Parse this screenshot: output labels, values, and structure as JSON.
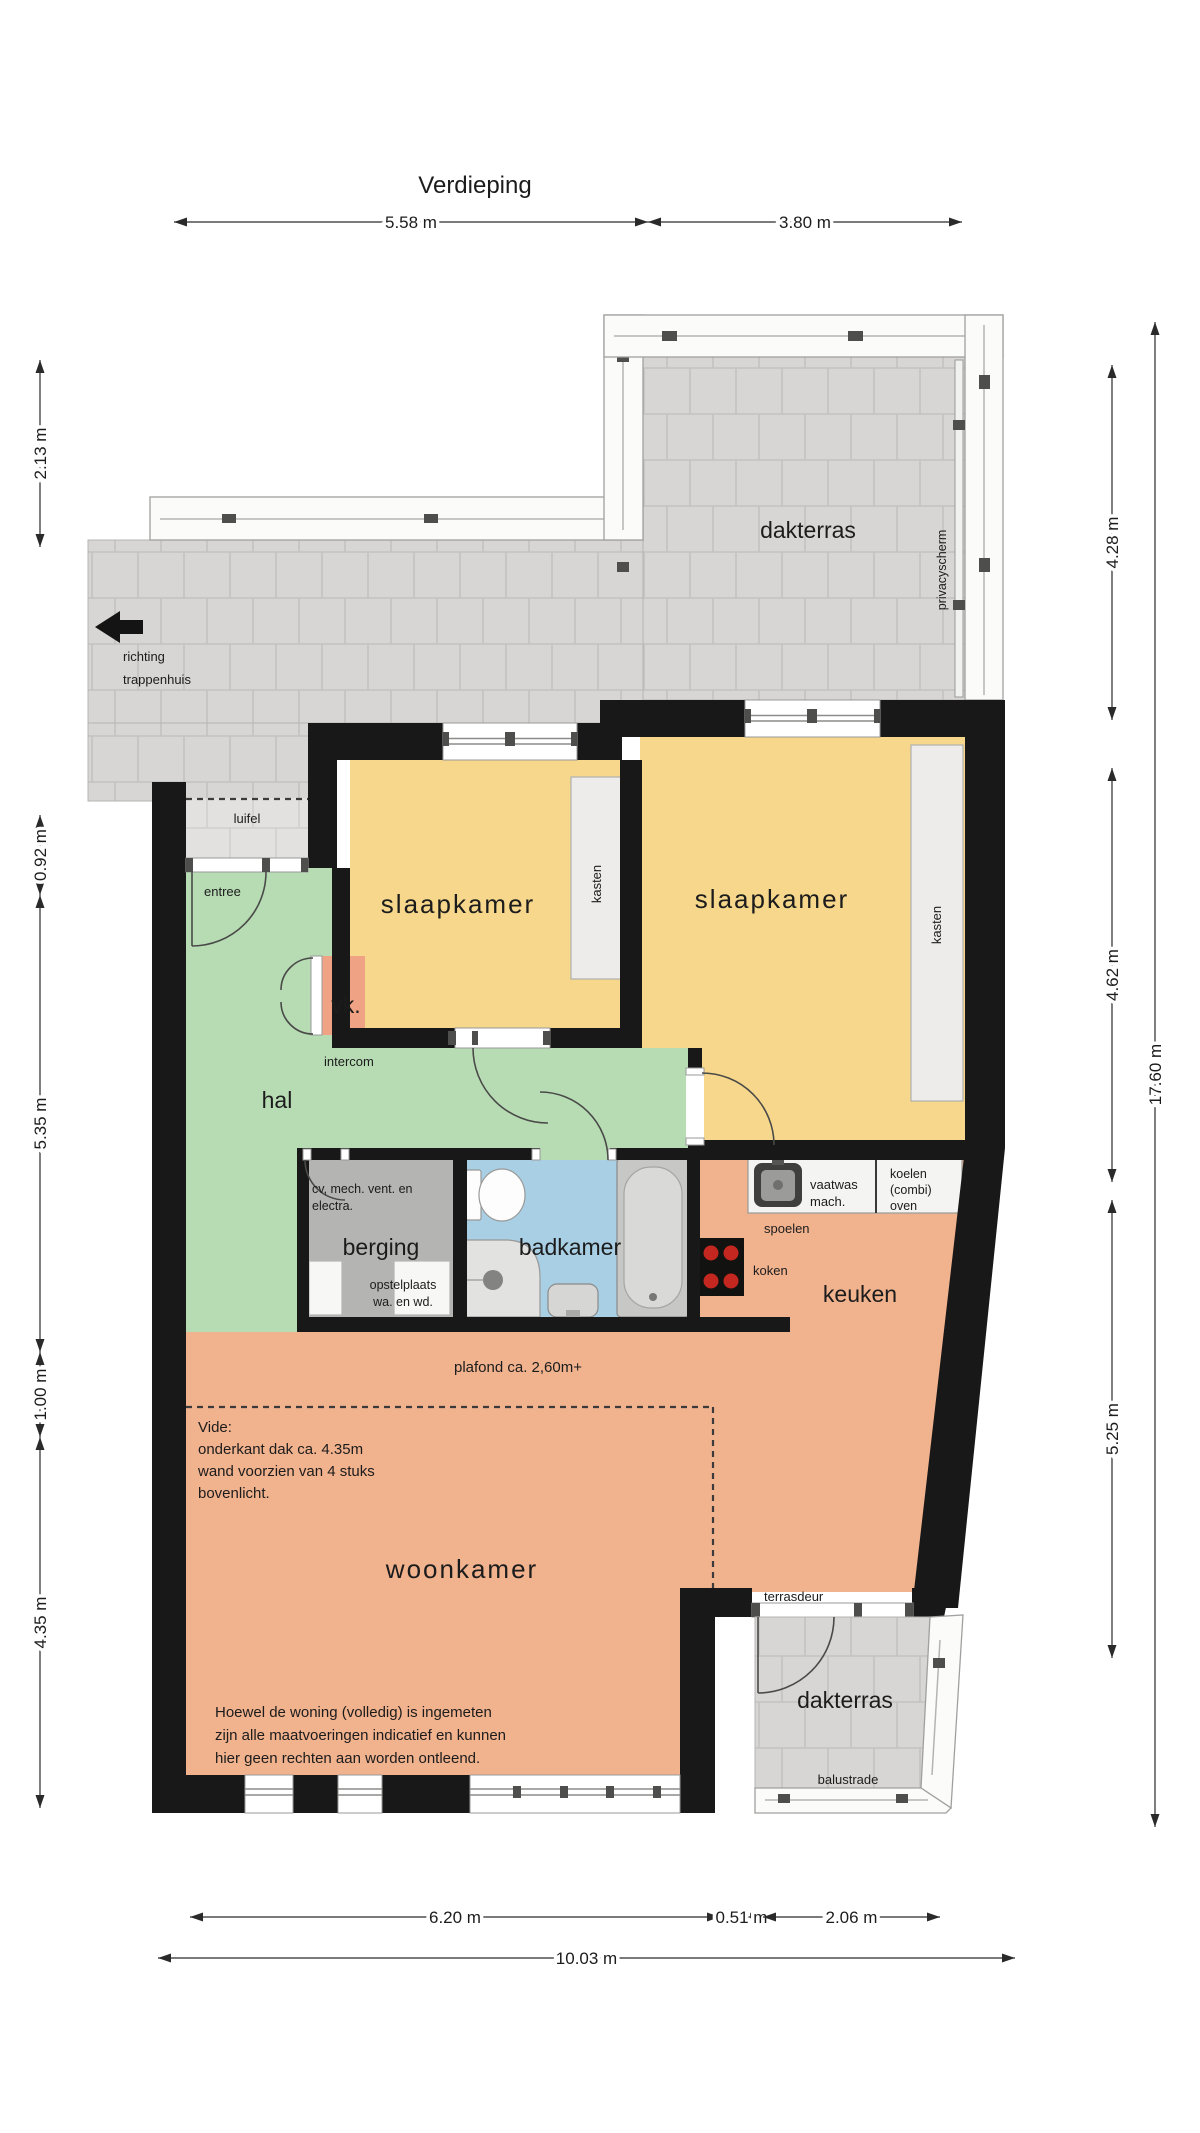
{
  "title": "Verdieping",
  "rooms": {
    "dakterras_top": "dakterras",
    "slaapkamer_1": "slaapkamer",
    "slaapkamer_2": "slaapkamer",
    "hal": "hal",
    "vk": "vk.",
    "berging": "berging",
    "badkamer": "badkamer",
    "keuken": "keuken",
    "woonkamer": "woonkamer",
    "dakterras_bottom": "dakterras"
  },
  "labels": {
    "richting_1": "richting",
    "richting_2": "trappenhuis",
    "luifel": "luifel",
    "entree": "entree",
    "intercom": "intercom",
    "kasten_1": "kasten",
    "kasten_2": "kasten",
    "privacyscherm": "privacyscherm",
    "cv_1": "cv, mech. vent. en",
    "cv_2": "electra.",
    "opstelplaats_1": "opstelplaats",
    "opstelplaats_2": "wa. en wd.",
    "spoelen": "spoelen",
    "koken": "koken",
    "vaatwas_1": "vaatwas",
    "vaatwas_2": "mach.",
    "koelen_1": "koelen",
    "koelen_2": "(combi)",
    "koelen_3": "oven",
    "plafond": "plafond ca. 2,60m+",
    "vide_1": "Vide:",
    "vide_2": "onderkant dak ca. 4.35m",
    "vide_3": "wand voorzien van 4 stuks",
    "vide_4": "bovenlicht.",
    "terrasdeur": "terrasdeur",
    "balustrade": "balustrade",
    "disclaimer_1": "Hoewel de woning (volledig) is ingemeten",
    "disclaimer_2": "zijn alle maatvoeringen indicatief en kunnen",
    "disclaimer_3": "hier geen rechten aan worden ontleend."
  },
  "dimensions": {
    "top": [
      {
        "id": "top-1",
        "label": "5.58 m",
        "x1": 174,
        "y1": 222,
        "x2": 648,
        "y2": 222
      },
      {
        "id": "top-2",
        "label": "3.80 m",
        "x1": 648,
        "y1": 222,
        "x2": 962,
        "y2": 222
      }
    ],
    "left": [
      {
        "id": "left-1",
        "label": "2.13 m",
        "x1": 40,
        "y1": 360,
        "x2": 40,
        "y2": 547
      },
      {
        "id": "left-2",
        "label": "0.92 m",
        "x1": 40,
        "y1": 815,
        "x2": 40,
        "y2": 895
      },
      {
        "id": "left-3",
        "label": "5.35 m",
        "x1": 40,
        "y1": 895,
        "x2": 40,
        "y2": 1352
      },
      {
        "id": "left-4",
        "label": "1.00 m",
        "x1": 40,
        "y1": 1352,
        "x2": 40,
        "y2": 1437
      },
      {
        "id": "left-5",
        "label": "4.35 m",
        "x1": 40,
        "y1": 1437,
        "x2": 40,
        "y2": 1808
      }
    ],
    "right": [
      {
        "id": "right-1",
        "label": "4.28 m",
        "x1": 1112,
        "y1": 365,
        "x2": 1112,
        "y2": 720
      },
      {
        "id": "right-2",
        "label": "4.62 m",
        "x1": 1112,
        "y1": 768,
        "x2": 1112,
        "y2": 1182
      },
      {
        "id": "right-3",
        "label": "5.25 m",
        "x1": 1112,
        "y1": 1200,
        "x2": 1112,
        "y2": 1658
      },
      {
        "id": "right-4",
        "label": "17.60 m",
        "x1": 1155,
        "y1": 322,
        "x2": 1155,
        "y2": 1827
      }
    ],
    "bottom": [
      {
        "id": "bottom-1",
        "label": "6.20 m",
        "x1": 190,
        "y1": 1917,
        "x2": 720,
        "y2": 1917
      },
      {
        "id": "bottom-2",
        "label": "0.51 m",
        "x1": 720,
        "y1": 1917,
        "x2": 763,
        "y2": 1917
      },
      {
        "id": "bottom-3",
        "label": "2.06 m",
        "x1": 763,
        "y1": 1917,
        "x2": 940,
        "y2": 1917
      },
      {
        "id": "bottom-4",
        "label": "10.03 m",
        "x1": 158,
        "y1": 1958,
        "x2": 1015,
        "y2": 1958
      }
    ]
  },
  "colors": {
    "wall": "#181818",
    "bedroom_yellow": "#f6d78c",
    "hall_green": "#b7dcb4",
    "living_orange": "#f1b28e",
    "bath_blue": "#a9cfe5",
    "storage_gray": "#b4b4b2",
    "tile_gray": "#d7d6d4",
    "balustrade_white": "#fbfbfa"
  }
}
